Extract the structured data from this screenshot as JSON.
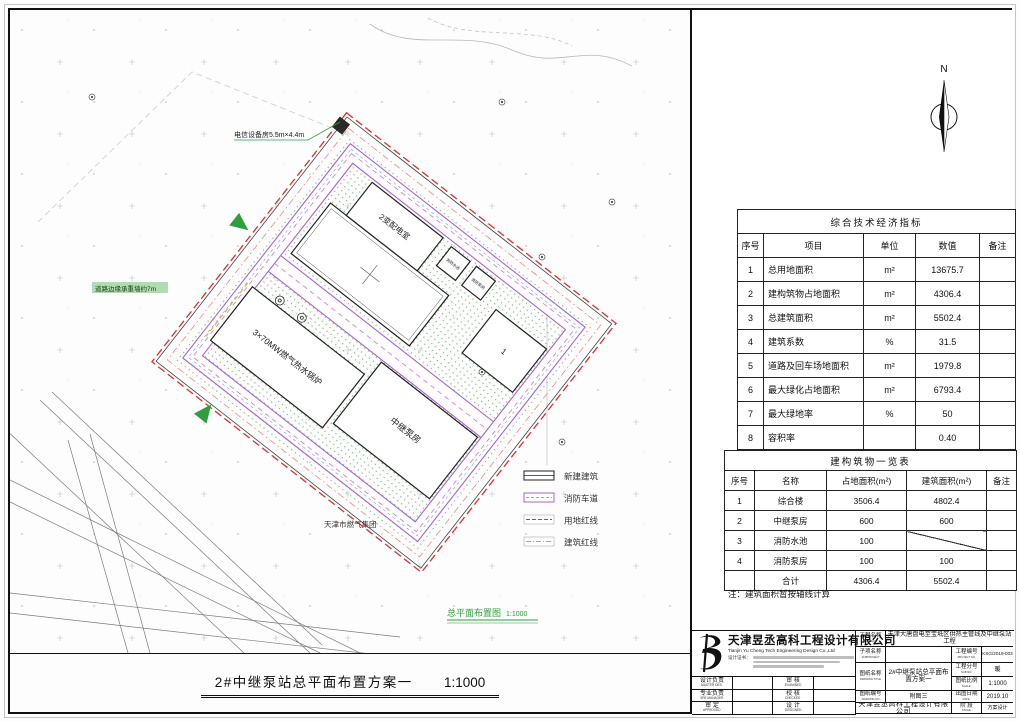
{
  "sheet": {
    "bottom_title": "2#中继泵站总平面布置方案一",
    "bottom_title_scale": "1:1000"
  },
  "drawing": {
    "caption": "总平面布置图",
    "caption_scale": "1:1000",
    "north_label": "N",
    "labels": {
      "telecom_room": "电信设备房5.5m×4.4m",
      "road_note": "道路边缘承重墙约7m",
      "substation": "2变配电室",
      "fire_pool": "消防水池",
      "fire_pump": "消防泵房",
      "boiler": "3×70MW燃气热水锅炉",
      "pump_house": "中继泵房",
      "building_one": "1",
      "gas_group": "天津市燃气集团"
    },
    "legend": {
      "items": [
        {
          "label": "新建建筑"
        },
        {
          "label": "消防车道"
        },
        {
          "label": "用地红线"
        },
        {
          "label": "建筑红线"
        }
      ]
    },
    "colors": {
      "land_redline": "#e03030",
      "building_redline": "#f08a8a",
      "fire_lane": "#a863d8",
      "fire_lane_dash": "#e87ad8",
      "greenery": "#4a9a4a",
      "entrance_green": "#2e9e3e"
    }
  },
  "tables": {
    "indicators": {
      "title": "综合技术经济指标",
      "columns": [
        "序号",
        "项目",
        "单位",
        "数值",
        "备注"
      ],
      "rows": [
        [
          "1",
          "总用地面积",
          "m²",
          "13675.7",
          ""
        ],
        [
          "2",
          "建构筑物占地面积",
          "m²",
          "4306.4",
          ""
        ],
        [
          "3",
          "总建筑面积",
          "m²",
          "5502.4",
          ""
        ],
        [
          "4",
          "建筑系数",
          "%",
          "31.5",
          ""
        ],
        [
          "5",
          "道路及回车场地面积",
          "m²",
          "1979.8",
          ""
        ],
        [
          "6",
          "最大绿化占地面积",
          "m²",
          "6793.4",
          ""
        ],
        [
          "7",
          "最大绿地率",
          "%",
          "50",
          ""
        ],
        [
          "8",
          "容积率",
          "",
          "0.40",
          ""
        ],
        [
          "9",
          "围墙长度",
          "m",
          "653.7",
          ""
        ]
      ]
    },
    "buildings": {
      "title": "建构筑物一览表",
      "columns": [
        "序号",
        "名称",
        "占地面积(m²)",
        "建筑面积(m²)",
        "备注"
      ],
      "rows": [
        [
          "1",
          "综合楼",
          "3506.4",
          "4802.4",
          ""
        ],
        [
          "2",
          "中继泵房",
          "600",
          "600",
          ""
        ],
        [
          "3",
          "消防水池",
          "100",
          "╱",
          ""
        ],
        [
          "4",
          "消防泵房",
          "100",
          "100",
          ""
        ],
        [
          "",
          "合计",
          "4306.4",
          "5502.4",
          ""
        ]
      ],
      "note": "注：建筑面积暂按轴线计算"
    }
  },
  "titleblock": {
    "company": {
      "name_cn": "天津昱丞高科工程设计有限公司",
      "name_en": "Tianjin Yu Cheng Tech  Engineering Design Co.,Ltd",
      "cert_label": "设计证书："
    },
    "fields": {
      "project_name_label": "工程名称",
      "project_name_label_en": "PROJECT",
      "project_name": "天津大唐盘电至宝坻区供热主管线及中继泵站工程",
      "subproject_label": "子项名称",
      "subproject_label_en": "SUBPROJECT",
      "subproject": "",
      "project_no_label": "工程编号",
      "project_no_label_en": "PROJECT NO.",
      "project_no": "KSG/2019-003",
      "drawing_title_label": "图纸名称",
      "drawing_title_label_en": "DRAWING TITLE",
      "drawing_title": "2#中继泵站总平面布置方案一",
      "sub_no_label": "工程分号",
      "sub_no_label_en": "SUB NO.",
      "sub_no": "暖",
      "scale_label": "图纸比例",
      "scale_label_en": "SCALE",
      "scale": "1:1000",
      "drawing_no_label": "图纸编号",
      "drawing_no_label_en": "DRAWING NO.",
      "drawing_no": "附图三",
      "date_label": "出图日期",
      "date_label_en": "DATE",
      "date": "2019.10",
      "stage_label": "阶 段",
      "stage_label_en": "STAGE",
      "stage": "方案设计",
      "bottom_company": "天津昱丞高科工程设计有限公司"
    },
    "signs": [
      {
        "cn": "设计负责",
        "en": "MASTER DES."
      },
      {
        "cn": "审 核",
        "en": "EXAMINED"
      },
      {
        "cn": "专业负责",
        "en": "SPE.MANAGER"
      },
      {
        "cn": "校 核",
        "en": "CHECKED"
      },
      {
        "cn": "审 定",
        "en": "APPROVED"
      },
      {
        "cn": "设 计",
        "en": "DESIGNED"
      }
    ]
  }
}
